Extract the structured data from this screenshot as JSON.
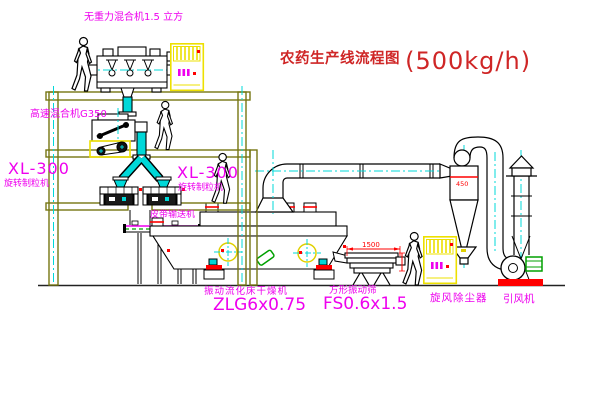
{
  "title": {
    "text": "农药生产线流程图",
    "capacity": "(500kg/h)"
  },
  "equipment_labels": {
    "gravity_mixer": "无重力混合机1.5 立方",
    "high_speed_mixer": "高速混合机G350",
    "granulator_left": {
      "model": "XL-300",
      "name": "旋转制粒机"
    },
    "granulator_right": {
      "model": "XL-300",
      "name": "旋转制粒机"
    },
    "belt_conveyor": "皮带输送机",
    "fluid_bed_dryer": {
      "name": "振动流化床干燥机",
      "model": "ZLG6x0.75"
    },
    "square_sieve": {
      "name": "方形振动筛",
      "model": "FS0.6x1.5"
    },
    "cyclone": "旋风除尘器",
    "induced_draft_fan": "引风机"
  },
  "dimensions": {
    "sieve_length": "1500",
    "cyclone_diameter": "450"
  },
  "colors": {
    "label_magenta": "#ee00ee",
    "title_red": "#cf2626",
    "dimension_red": "#ff0000",
    "structure_olive": "#767612",
    "pipe_cyan": "#00d8d8",
    "cabinet_yellow": "#ede000",
    "line_black": "#000000",
    "motor_green": "#00a000"
  }
}
